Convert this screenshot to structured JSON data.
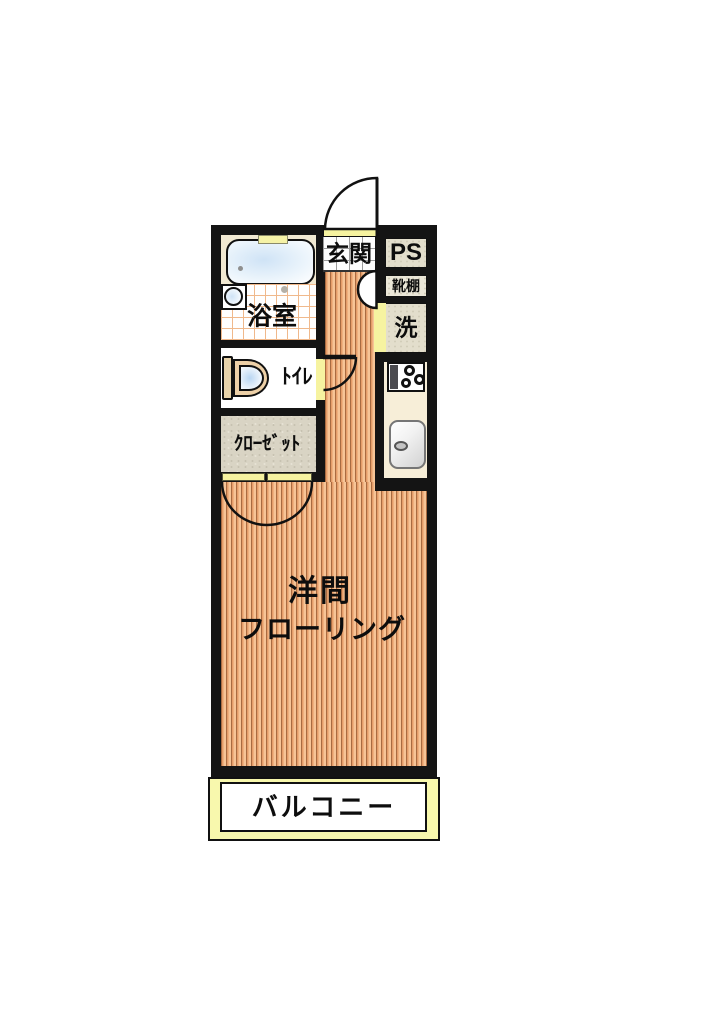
{
  "plan": {
    "type": "apartment-floorplan",
    "labels": {
      "entrance": "玄関",
      "pipe_space": "PS",
      "shoe_shelf": "靴棚",
      "washer": "洗",
      "bathroom": "浴室",
      "toilet": "ﾄｲﾚ",
      "closet": "ｸﾛｰｾﾞｯﾄ",
      "main_room": "洋間",
      "main_room_flooring": "フローリング",
      "balcony": "バルコニー"
    },
    "colors": {
      "wall": "#141414",
      "flooring_light": "#f7c496",
      "flooring_mid": "#e59c68",
      "flooring_line": "#a96b41",
      "bath_tile_line": "#f0b98c",
      "entry_tile_line": "#9b9b9b",
      "door_yellow": "#f6f3a0",
      "balcony_yellow": "#f8f8ad",
      "texture_beige": "#e3decc",
      "closet_grey": "#d9d4c4",
      "counter_cream": "#f7eed8",
      "water_blue": "#cfe3f6"
    }
  }
}
